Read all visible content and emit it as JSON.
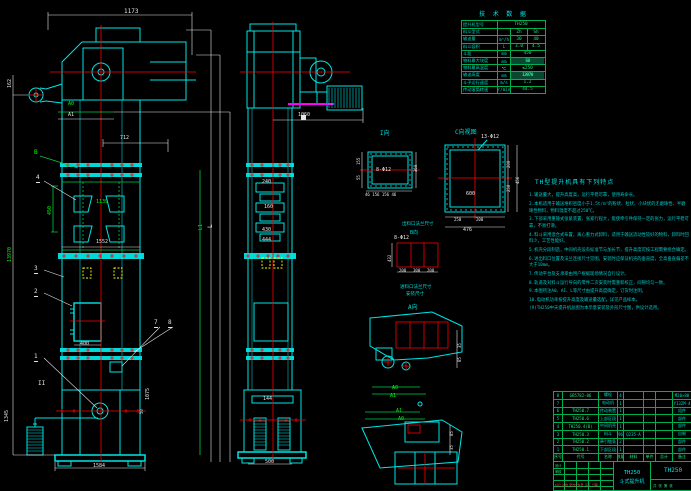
{
  "colors": {
    "background": "#000000",
    "cyan": "#00e5e5",
    "green": "#00ff00",
    "red": "#ff0000",
    "yellow": "#ffff00",
    "magenta": "#ff00ff",
    "white": "#e6e6e6"
  },
  "tech_table": {
    "title": "技 术 数 据",
    "rows": [
      {
        "label": "提升机型号",
        "unit": "",
        "values": [
          "TH250"
        ],
        "wide": true
      },
      {
        "label": "料斗型式",
        "unit": "",
        "values": [
          "Zh",
          "Sh"
        ]
      },
      {
        "label": "输送量",
        "unit": "m³/h",
        "values": [
          "30",
          "40"
        ]
      },
      {
        "label": "料斗容积",
        "unit": "L",
        "values": [
          "3.0",
          "4.5"
        ]
      },
      {
        "label": "斗距",
        "unit": "mm",
        "values": [
          "450"
        ]
      },
      {
        "label": "物料最大块度",
        "unit": "mm",
        "values": [
          "50"
        ],
        "hl": true
      },
      {
        "label": "物料最高温度",
        "unit": "℃",
        "values": [
          "≤250"
        ]
      },
      {
        "label": "输送高度",
        "unit": "mm",
        "values": [
          "13970"
        ],
        "hl": true
      },
      {
        "label": "斗子运行速度",
        "unit": "m/s",
        "values": [
          "1.2"
        ]
      },
      {
        "label": "传动滚筒转速",
        "unit": "r/min",
        "values": [
          "44.5"
        ]
      }
    ]
  },
  "features": {
    "title": "TH型提升机具有下列特点",
    "items": [
      "1.输送量大，提升高度高，运行平稳可靠，使用寿命长。",
      "2.本机适用于输送堆积密度小于1.5t/m³的粉状、粒状、小块状的无磨琢性、半磨琢性物料，物料温度不超过250℃。",
      "3.下部采用重锤式张紧装置，张紧行程大，能使牵引件保持一定的张力，运行平稳可靠，不易打滑。",
      "4.料斗采用混合式布置，离心重力式卸料，适用于输送流动性较好的物料，卸料时回料少，工艺性能好。",
      "5.机壳分段制造，中间机壳设有标准节与加长节，提升高度可按工程需要组合确定。",
      "6.进出料口位置及法兰连接尺寸见图，安装时应保证机壳的垂直度，全高垂直偏差不大于10mm。",
      "7.传动平台及支承梁由用户根据现场情况自行设计。",
      "8.轨道及对料斗运行导向的零件二次安装时需重新校正，间隙均匀一致。",
      "9.本图所注A0、A1、L等尺寸由提升高度确定，订货时注明。",
      "10.电动机功率按提升高度及输送量选配，详见产品样本。",
      "(9)TH250中天提升机总图为本示意安装及外形尺寸图，供设计选用。"
    ]
  },
  "bom": {
    "headers": [
      "序号",
      "代号",
      "名称",
      "数量",
      "材料",
      "单件",
      "总计",
      "备注"
    ],
    "rows": [
      [
        "8",
        "GB5782-86",
        "螺栓",
        "4",
        "",
        "",
        "",
        "M20×80"
      ],
      [
        "7",
        "",
        "电动机",
        "1",
        "",
        "",
        "",
        "Y132M-4"
      ],
      [
        "6",
        "TH250.7",
        "传动装置",
        "1",
        "",
        "",
        "",
        "组件"
      ],
      [
        "5",
        "TH250.6",
        "上部区段",
        "1",
        "",
        "",
        "",
        "部件"
      ],
      [
        "4",
        "TH250.4(B)",
        "中间机壳",
        "1",
        "",
        "",
        "",
        "部件"
      ],
      [
        "3",
        "TH250.3",
        "料斗",
        "96",
        "Q235-A",
        "",
        "",
        "自制"
      ],
      [
        "2",
        "TH250.2",
        "牵引链条",
        "2",
        "",
        "",
        "",
        "部件"
      ],
      [
        "1",
        "TH250.1",
        "下部区段",
        "1",
        "",
        "",
        "",
        "部件"
      ]
    ]
  },
  "title_block": {
    "model": "TH250",
    "product_name": "斗式提升机",
    "drawing_no": "TH250",
    "marks_row": "标记 处数 更改文件号 签字 日期",
    "sig_design": "设计",
    "sig_check": "审核",
    "sheets": "共 张 第 张"
  },
  "annotations": [
    {
      "n": "dim-1173",
      "t": "1173",
      "x": 124,
      "y": 9,
      "c": "w",
      "s": 6
    },
    {
      "n": "dim-162",
      "t": "162",
      "x": 8,
      "y": 88,
      "c": "w",
      "s": 5,
      "r": 1
    },
    {
      "n": "label-a0-head",
      "t": "A0",
      "x": 68,
      "y": 102,
      "c": "g",
      "s": 5
    },
    {
      "n": "label-a1-head",
      "t": "A1",
      "x": 68,
      "y": 113,
      "c": "w",
      "s": 5
    },
    {
      "n": "dim-712",
      "t": "712",
      "x": 120,
      "y": 136,
      "c": "w",
      "s": 5
    },
    {
      "n": "label-b-view",
      "t": "B",
      "x": 34,
      "y": 150,
      "c": "g",
      "s": 6
    },
    {
      "n": "balloon-4",
      "t": "4",
      "x": 36,
      "y": 175,
      "c": "w",
      "s": 6,
      "b": 1
    },
    {
      "n": "dim-450",
      "t": "450",
      "x": 48,
      "y": 215,
      "c": "g",
      "s": 5,
      "r": 1
    },
    {
      "n": "dim-1139",
      "t": "1139",
      "x": 96,
      "y": 200,
      "c": "g",
      "s": 5
    },
    {
      "n": "dim-1552",
      "t": "1552",
      "x": 96,
      "y": 240,
      "c": "w",
      "s": 5
    },
    {
      "n": "balloon-3",
      "t": "3",
      "x": 34,
      "y": 266,
      "c": "w",
      "s": 6,
      "b": 1
    },
    {
      "n": "balloon-2",
      "t": "2",
      "x": 34,
      "y": 289,
      "c": "w",
      "s": 6,
      "b": 1
    },
    {
      "n": "dim-400",
      "t": "400",
      "x": 80,
      "y": 342,
      "c": "w",
      "s": 5
    },
    {
      "n": "balloon-7",
      "t": "7",
      "x": 154,
      "y": 320,
      "c": "w",
      "s": 6,
      "b": 1
    },
    {
      "n": "balloon-8",
      "t": "8",
      "x": 168,
      "y": 320,
      "c": "w",
      "s": 6,
      "b": 1
    },
    {
      "n": "balloon-1",
      "t": "1",
      "x": 34,
      "y": 354,
      "c": "w",
      "s": 6,
      "b": 1
    },
    {
      "n": "section-mark-ii",
      "t": "II",
      "x": 38,
      "y": 381,
      "c": "w",
      "s": 6
    },
    {
      "n": "dim-1075",
      "t": "1075",
      "x": 146,
      "y": 400,
      "c": "w",
      "s": 5,
      "r": 1
    },
    {
      "n": "dim-50",
      "t": "50",
      "x": 140,
      "y": 414,
      "c": "w",
      "s": 4,
      "r": 1
    },
    {
      "n": "dim-1345",
      "t": "1345",
      "x": 5,
      "y": 422,
      "c": "w",
      "s": 5,
      "r": 1
    },
    {
      "n": "dim-total-height",
      "t": "13970",
      "x": 8,
      "y": 262,
      "c": "g",
      "s": 5,
      "r": 1
    },
    {
      "n": "dim-1584",
      "t": "1584",
      "x": 93,
      "y": 464,
      "c": "w",
      "s": 5
    },
    {
      "n": "dim-l",
      "t": "L",
      "x": 208,
      "y": 228,
      "c": "w",
      "s": 6,
      "r": 1
    },
    {
      "n": "dim-l1",
      "t": "L1",
      "x": 199,
      "y": 230,
      "c": "g",
      "s": 5,
      "r": 1
    },
    {
      "n": "dim-1060",
      "t": "1060",
      "x": 298,
      "y": 113,
      "c": "w",
      "s": 5
    },
    {
      "n": "dim-240",
      "t": "240",
      "x": 262,
      "y": 180,
      "c": "w",
      "s": 5
    },
    {
      "n": "dim-160",
      "t": "160",
      "x": 264,
      "y": 205,
      "c": "w",
      "s": 5
    },
    {
      "n": "dim-430",
      "t": "430",
      "x": 262,
      "y": 228,
      "c": "w",
      "s": 5
    },
    {
      "n": "dim-444",
      "t": "444",
      "x": 262,
      "y": 238,
      "c": "w",
      "s": 5
    },
    {
      "n": "dim-144",
      "t": "144",
      "x": 263,
      "y": 397,
      "c": "w",
      "s": 5
    },
    {
      "n": "dim-500",
      "t": "500",
      "x": 265,
      "y": 460,
      "c": "w",
      "s": 5
    },
    {
      "n": "label-view-i",
      "t": "I向",
      "x": 380,
      "y": 131,
      "c": "c",
      "s": 6
    },
    {
      "n": "note-8-phi12-i",
      "t": "8-Φ12",
      "x": 376,
      "y": 168,
      "c": "w",
      "s": 5
    },
    {
      "n": "dim-155-i",
      "t": "155",
      "x": 357,
      "y": 165,
      "c": "w",
      "s": 4,
      "r": 1
    },
    {
      "n": "dim-55-i",
      "t": "55",
      "x": 357,
      "y": 180,
      "c": "w",
      "s": 4,
      "r": 1
    },
    {
      "n": "dim-360-i",
      "t": "360",
      "x": 414,
      "y": 172,
      "c": "w",
      "s": 4,
      "r": 1
    },
    {
      "n": "dim-i-bottom",
      "t": "46 156 156 46",
      "x": 365,
      "y": 193,
      "c": "w",
      "s": 4
    },
    {
      "n": "label-view-c",
      "t": "C向视图",
      "x": 455,
      "y": 130,
      "c": "c",
      "s": 6
    },
    {
      "n": "note-13-phi12",
      "t": "13-Φ12",
      "x": 481,
      "y": 135,
      "c": "w",
      "s": 5
    },
    {
      "n": "dim-600-c",
      "t": "600",
      "x": 466,
      "y": 192,
      "c": "w",
      "s": 5
    },
    {
      "n": "dim-250-c",
      "t": "250",
      "x": 454,
      "y": 218,
      "c": "w",
      "s": 4
    },
    {
      "n": "dim-200-c",
      "t": "200",
      "x": 476,
      "y": 218,
      "c": "w",
      "s": 4
    },
    {
      "n": "dim-476-c",
      "t": "476",
      "x": 463,
      "y": 228,
      "c": "w",
      "s": 5
    },
    {
      "n": "dim-200r-c",
      "t": "200",
      "x": 507,
      "y": 168,
      "c": "w",
      "s": 4,
      "r": 1
    },
    {
      "n": "dim-250r-c",
      "t": "250",
      "x": 507,
      "y": 192,
      "c": "w",
      "s": 4,
      "r": 1
    },
    {
      "n": "dim-456-c",
      "t": "456",
      "x": 516,
      "y": 184,
      "c": "w",
      "s": 4,
      "r": 1
    },
    {
      "n": "note-outlet-flange",
      "t": "出料口法兰尺寸",
      "x": 402,
      "y": 223,
      "c": "c",
      "s": 4.5
    },
    {
      "n": "label-view-b",
      "t": "B向",
      "x": 410,
      "y": 231,
      "c": "c",
      "s": 5
    },
    {
      "n": "note-8-phi12-b",
      "t": "8-Φ12",
      "x": 394,
      "y": 236,
      "c": "w",
      "s": 5
    },
    {
      "n": "dim-432",
      "t": "432",
      "x": 388,
      "y": 262,
      "c": "w",
      "s": 4,
      "r": 1
    },
    {
      "n": "dim-200a",
      "t": "200",
      "x": 399,
      "y": 269,
      "c": "w",
      "s": 4
    },
    {
      "n": "dim-300a",
      "t": "300",
      "x": 413,
      "y": 269,
      "c": "w",
      "s": 4
    },
    {
      "n": "dim-200b",
      "t": "200",
      "x": 427,
      "y": 269,
      "c": "w",
      "s": 4
    },
    {
      "n": "note-inlet-flange",
      "t": "进料口法兰尺寸",
      "x": 400,
      "y": 286,
      "c": "c",
      "s": 4.5
    },
    {
      "n": "note-inlet-size",
      "t": "安装尺寸",
      "x": 406,
      "y": 293,
      "c": "c",
      "s": 4.5
    },
    {
      "n": "label-view-a",
      "t": "A向",
      "x": 408,
      "y": 305,
      "c": "c",
      "s": 6
    },
    {
      "n": "label-a0-upper",
      "t": "A0",
      "x": 392,
      "y": 386,
      "c": "g",
      "s": 5
    },
    {
      "n": "label-a1-upper",
      "t": "A1",
      "x": 390,
      "y": 394,
      "c": "g",
      "s": 5
    },
    {
      "n": "dim-35-upper",
      "t": "35",
      "x": 458,
      "y": 348,
      "c": "w",
      "s": 4,
      "r": 1
    },
    {
      "n": "dim-85-upper",
      "t": "85",
      "x": 458,
      "y": 362,
      "c": "w",
      "s": 4,
      "r": 1
    },
    {
      "n": "label-a1-lower",
      "t": "A1",
      "x": 396,
      "y": 409,
      "c": "g",
      "s": 5
    },
    {
      "n": "label-a0-lower",
      "t": "A0",
      "x": 398,
      "y": 417,
      "c": "g",
      "s": 5
    },
    {
      "n": "dim-85-lower",
      "t": "85",
      "x": 450,
      "y": 436,
      "c": "w",
      "s": 4,
      "r": 1
    },
    {
      "n": "dim-35-lower",
      "t": "35",
      "x": 450,
      "y": 450,
      "c": "w",
      "s": 4,
      "r": 1
    }
  ]
}
